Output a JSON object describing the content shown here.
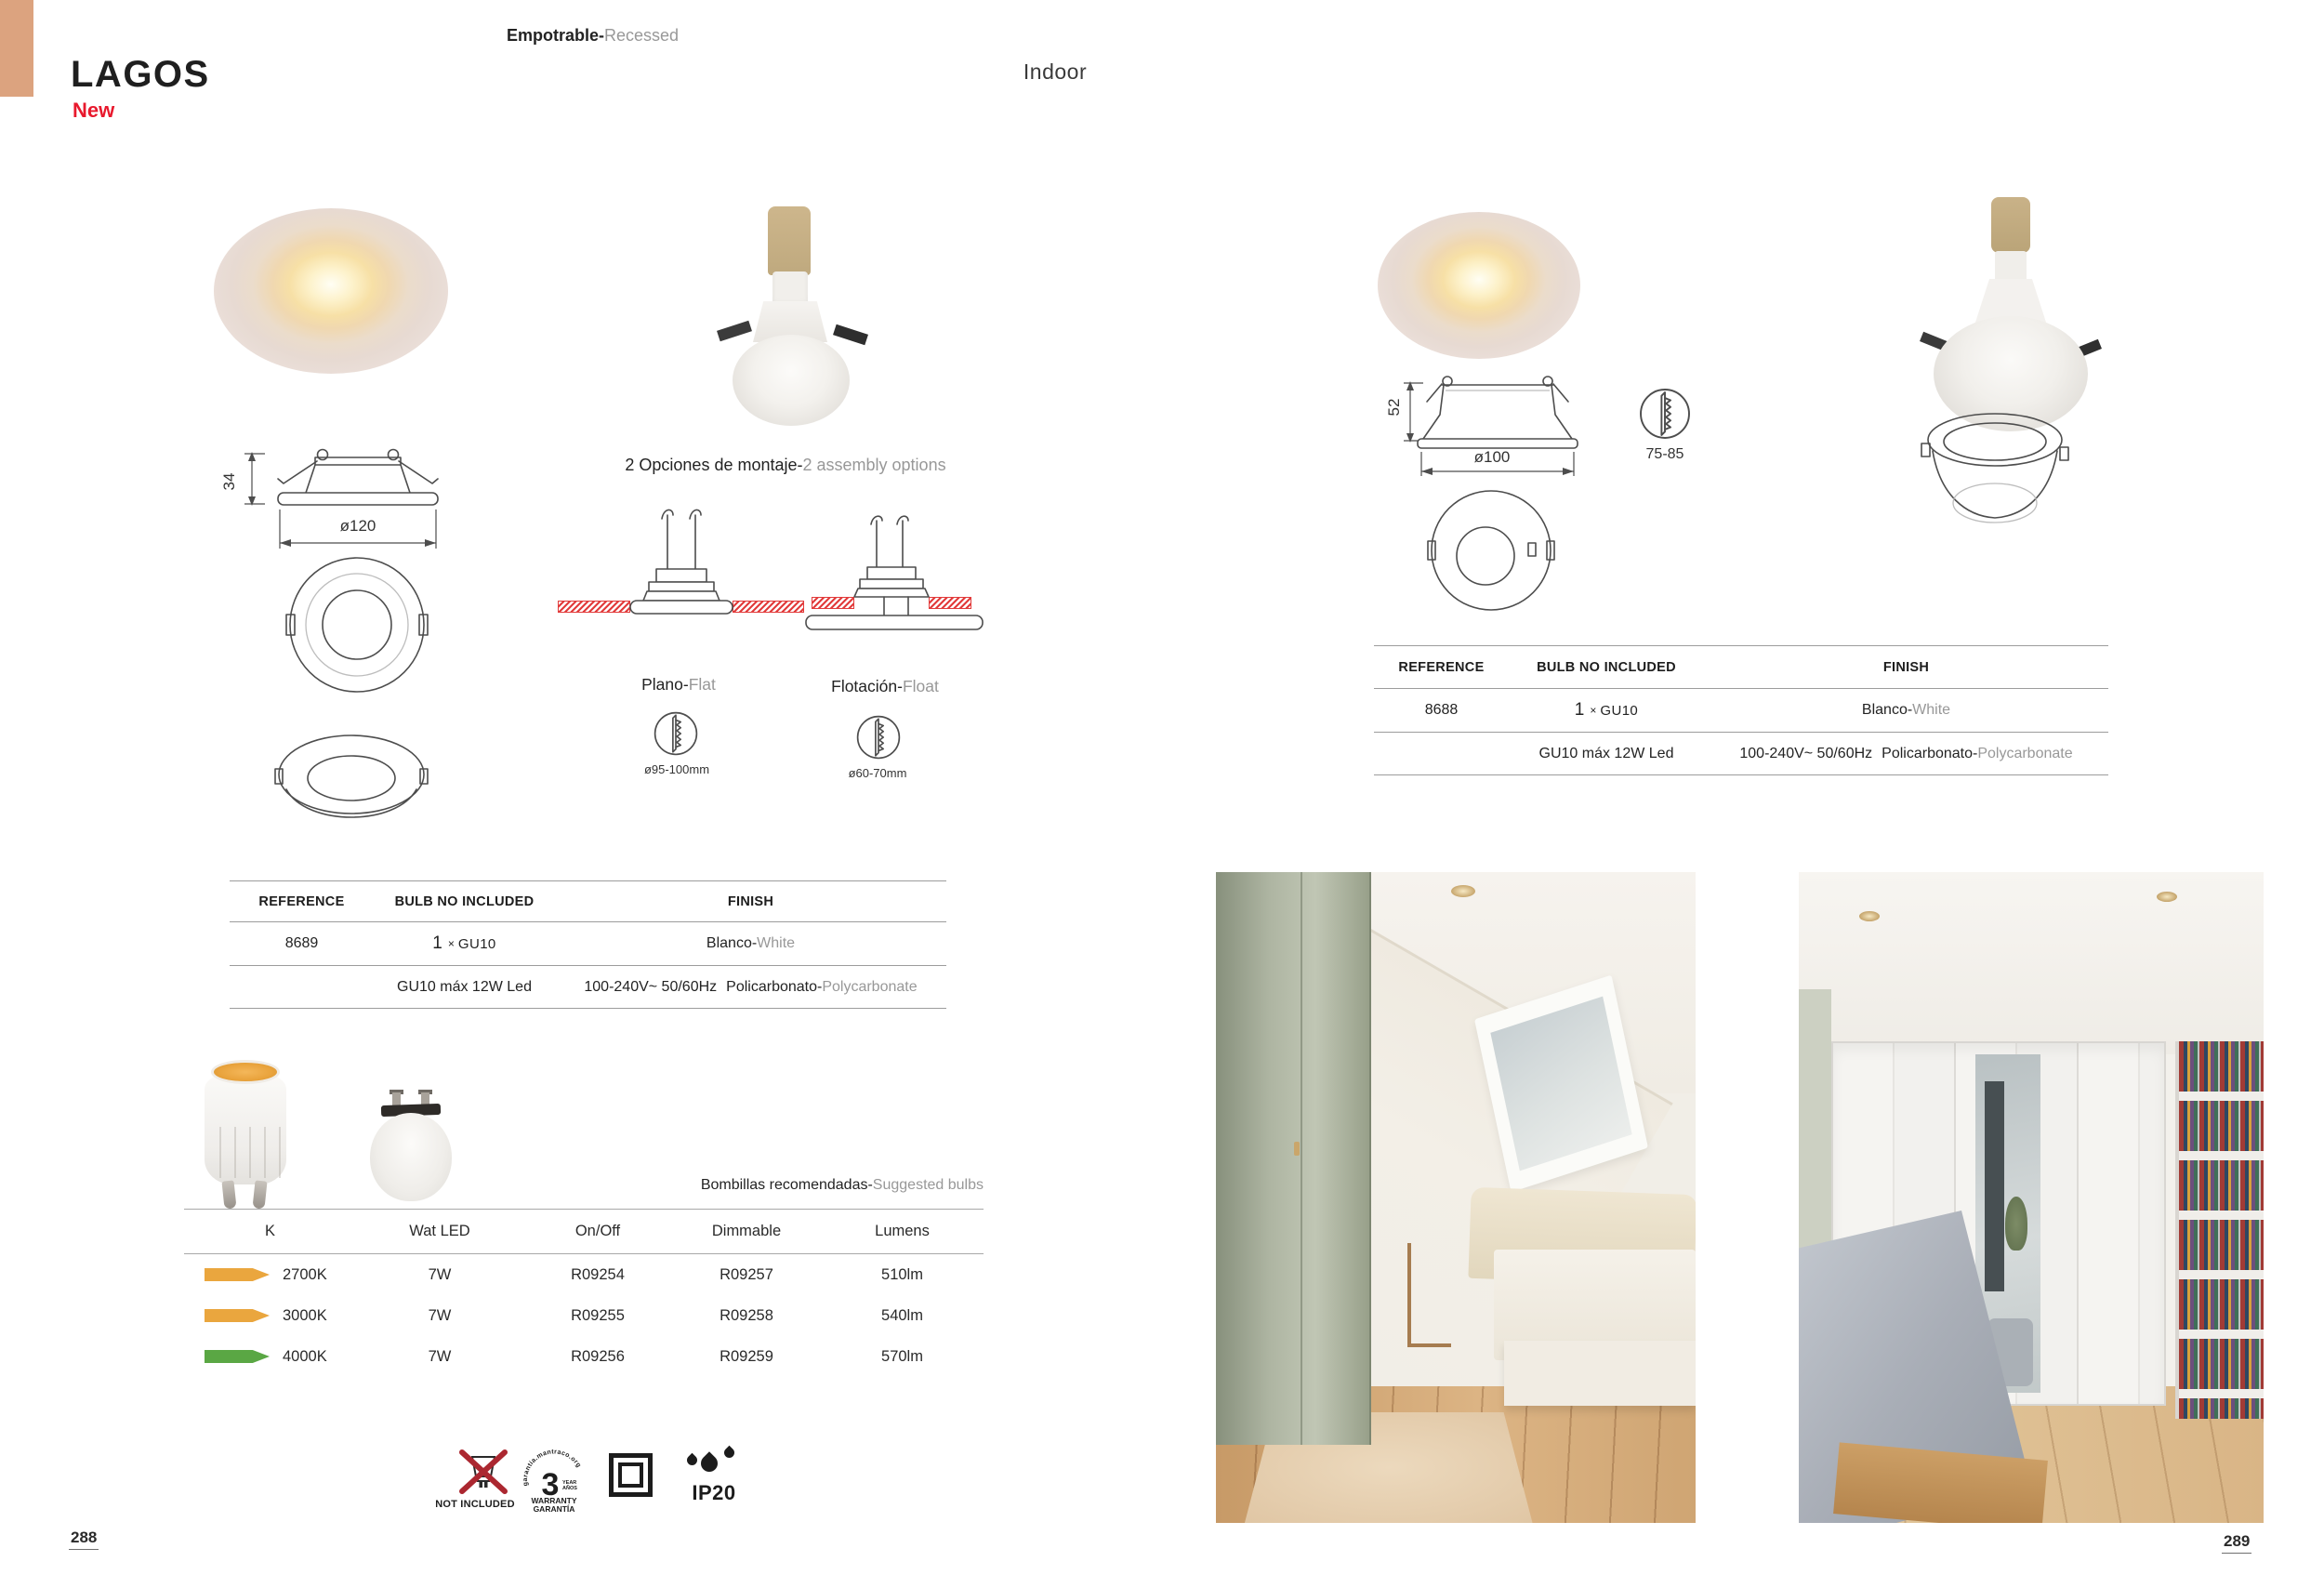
{
  "colors": {
    "accent": "#dca37f",
    "new_red": "#e8192d",
    "hatch_red": "#e23b3b"
  },
  "header": {
    "title": "LAGOS",
    "badge": "New",
    "category_es": "Empotrable-",
    "category_en": "Recessed",
    "location": "Indoor"
  },
  "left_product": {
    "dims": {
      "height": "34",
      "diameter": "ø120"
    },
    "assembly": {
      "title_es": "2 Opciones de montaje-",
      "title_en": "2 assembly options",
      "flat_es": "Plano-",
      "flat_en": "Flat",
      "flat_hole": "ø95-100mm",
      "float_es": "Flotación-",
      "float_en": "Float",
      "float_hole": "ø60-70mm"
    },
    "table": {
      "headers": [
        "REFERENCE",
        "BULB NO INCLUDED",
        "FINISH"
      ],
      "reference": "8689",
      "bulb_qty": "1",
      "bulb_times": "×",
      "bulb_type": "GU10",
      "finish_es": "Blanco-",
      "finish_en": "White",
      "bulb_spec": "GU10 máx 12W Led",
      "voltage": "100-240V~ 50/60Hz",
      "material_es": "Policarbonato-",
      "material_en": "Polycarbonate"
    }
  },
  "right_product": {
    "dims": {
      "height": "52",
      "diameter": "ø100",
      "cutout": "75-85"
    },
    "table": {
      "headers": [
        "REFERENCE",
        "BULB NO INCLUDED",
        "FINISH"
      ],
      "reference": "8688",
      "bulb_qty": "1",
      "bulb_times": "×",
      "bulb_type": "GU10",
      "finish_es": "Blanco-",
      "finish_en": "White",
      "bulb_spec": "GU10 máx 12W Led",
      "voltage": "100-240V~ 50/60Hz",
      "material_es": "Policarbonato-",
      "material_en": "Polycarbonate"
    }
  },
  "bulbs": {
    "title_es": "Bombillas recomendadas-",
    "title_en": "Suggested bulbs",
    "headers": [
      "K",
      "Wat LED",
      "On/Off",
      "Dimmable",
      "Lumens"
    ],
    "rows": [
      {
        "k": "2700K",
        "arrow_color": "#eaa63e",
        "watt": "7W",
        "on_off": "R09254",
        "dimmable": "R09257",
        "lumens": "510lm"
      },
      {
        "k": "3000K",
        "arrow_color": "#eaa63e",
        "watt": "7W",
        "on_off": "R09255",
        "dimmable": "R09258",
        "lumens": "540lm"
      },
      {
        "k": "4000K",
        "arrow_color": "#5aa744",
        "watt": "7W",
        "on_off": "R09256",
        "dimmable": "R09259",
        "lumens": "570lm"
      }
    ]
  },
  "badges": {
    "not_included": "NOT INCLUDED",
    "warranty": {
      "arc": "garantia.mantraco.org",
      "number": "3",
      "year": "YEAR",
      "anios": "AÑOS",
      "line1": "WARRANTY",
      "line2": "GARANTÍA"
    },
    "ip": "IP20"
  },
  "pages": {
    "left": "288",
    "right": "289"
  }
}
